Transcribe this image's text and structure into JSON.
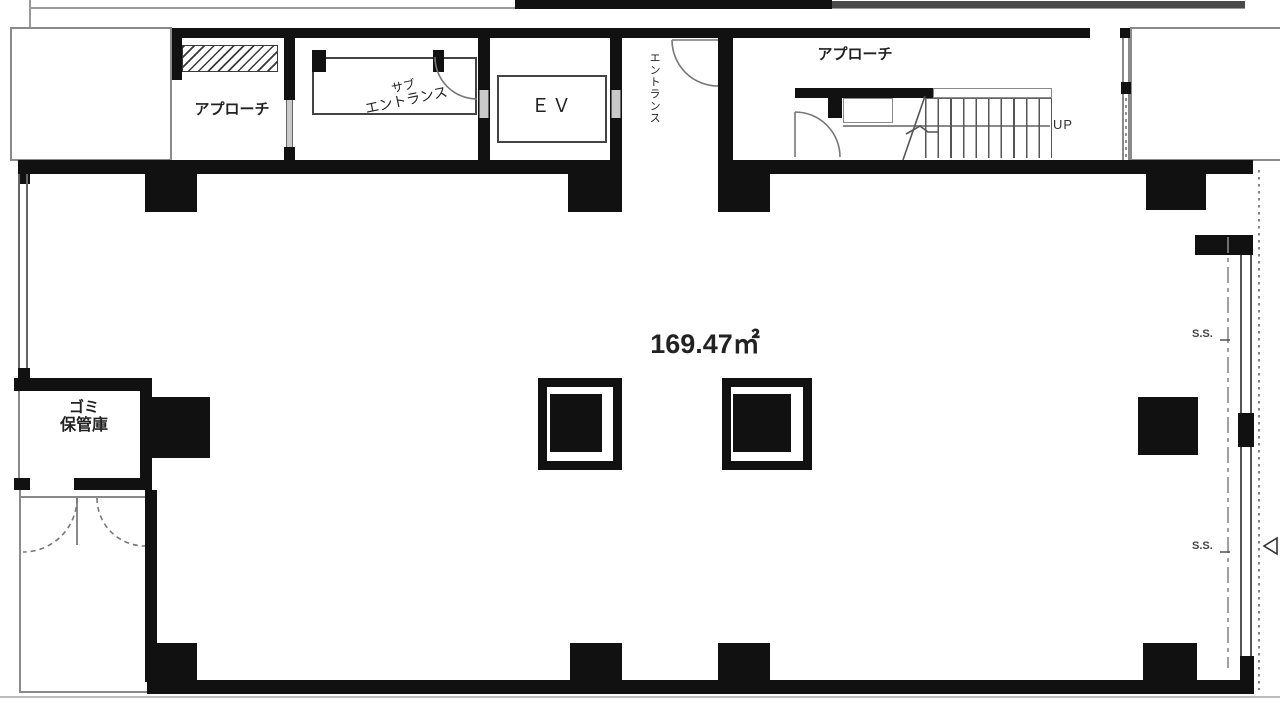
{
  "labels": {
    "approach_small": "アプローチ",
    "sub_entrance_line1": "サブ",
    "sub_entrance_line2": "エントランス",
    "ev": "ＥＶ",
    "entrance_vertical": "エントランス",
    "approach_top": "アプローチ",
    "up": "UP",
    "area": "169.47㎡",
    "garbage_line1": "ゴミ",
    "garbage_line2": "保管庫",
    "ss_top": "S.S.",
    "ss_bottom": "S.S."
  },
  "colors": {
    "wall": "#111111",
    "thin_line": "#8a8a8a",
    "text": "#222222",
    "background": "#ffffff"
  }
}
